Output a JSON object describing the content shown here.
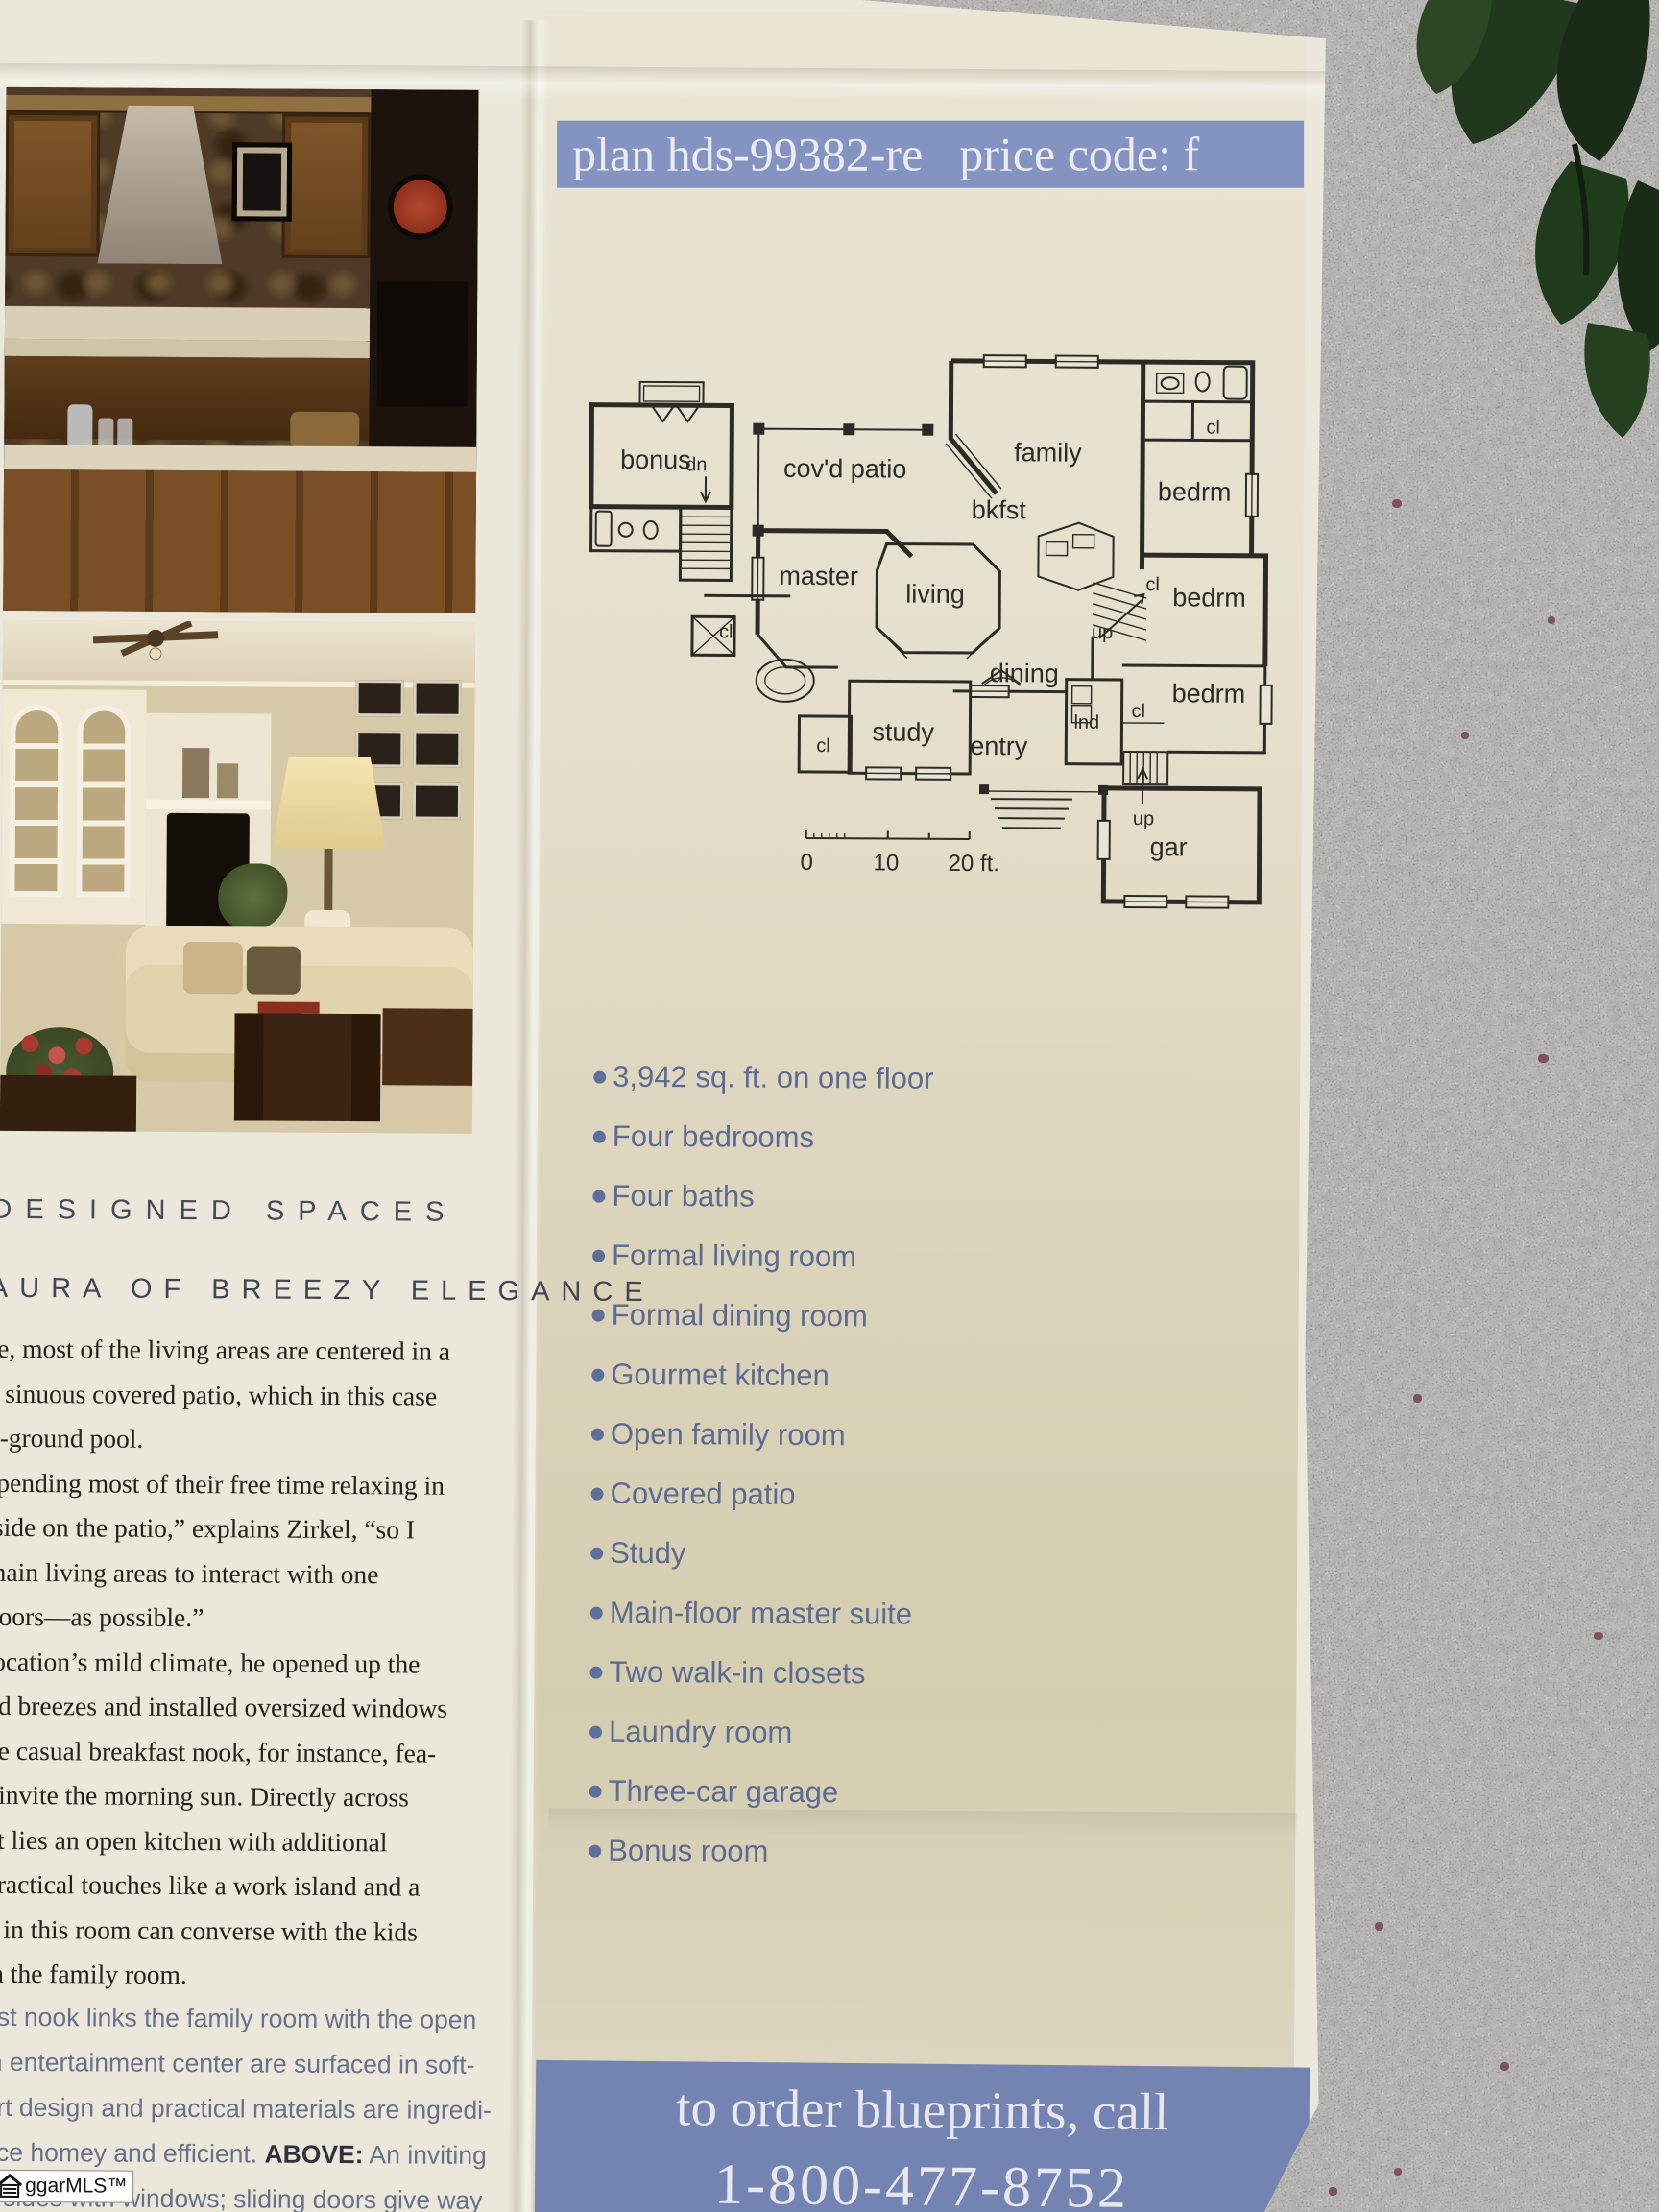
{
  "colors": {
    "granite": "#8d8c88",
    "paper": "#ebe7da",
    "panel_tan": "#d5cdb0",
    "band_top_blue": "#8494c2",
    "band_bottom_blue": "#7484b2",
    "feature_text_blue": "#5c6b92",
    "plan_ink": "#2b2a24",
    "leaf_green": "#24391f"
  },
  "header": {
    "plan": "plan hds-99382-re",
    "price": "price code: f"
  },
  "floor_plan": {
    "labels": {
      "bonus": "bonus",
      "dn": "dn",
      "covd_patio": "cov'd patio",
      "family": "family",
      "bkfst": "bkfst",
      "master": "master",
      "living": "living",
      "dining": "dining",
      "study": "study",
      "entry": "entry",
      "gar": "gar",
      "lnd": "lnd",
      "bedrm_top": "bedrm",
      "bedrm_mid": "bedrm",
      "bedrm_low": "bedrm",
      "cl_top": "cl",
      "cl_mid": "cl",
      "cl_left": "cl",
      "cl_low": "cl",
      "cl_study": "cl",
      "up_mid": "up",
      "up_right": "up"
    },
    "scale": {
      "zero": "0",
      "ten": "10",
      "twenty": "20 ft."
    }
  },
  "features": [
    "3,942 sq. ft. on one floor",
    "Four bedrooms",
    "Four baths",
    "Formal living room",
    "Formal dining room",
    "Gourmet kitchen",
    "Open family room",
    "Covered patio",
    "Study",
    "Main-floor master suite",
    "Two walk-in closets",
    "Laundry room",
    "Three-car garage",
    "Bonus room"
  ],
  "order_band": {
    "line1": "to order blueprints, call",
    "phone": "1-800-477-8752"
  },
  "left_column": {
    "kicker": "DESIGNED SPACES",
    "headline": "AURA OF BREEZY ELEGANCE",
    "serif_lines": [
      "se, most of the living areas are centered in a",
      "a sinuous covered patio, which in this case",
      "n-ground pool.",
      "spending most of their free time relaxing in",
      "tside on the patio,” explains Zirkel, “so I",
      "main living areas to interact with one",
      "doors—as possible.”",
      "location’s mild climate, he opened up the",
      "nd breezes and installed oversized windows",
      "he casual breakfast nook, for instance, fea-",
      "t invite the morning sun. Directly across",
      "ot lies an open kitchen with additional",
      "practical touches like a work island and a",
      "g in this room can converse with the kids",
      "in the family room."
    ],
    "sans_lines": [
      "ast nook links the family room with the open",
      "in entertainment center are surfaced in soft-",
      "art design and practical materials are ingredi-"
    ],
    "above": {
      "pre": "nce homey and efficient. ",
      "label": "ABOVE:",
      "post": " An inviting"
    },
    "sans_lines2": [
      "o sides with windows; sliding doors give way",
      "back of the house."
    ],
    "watermark": "ggarMLS™"
  }
}
